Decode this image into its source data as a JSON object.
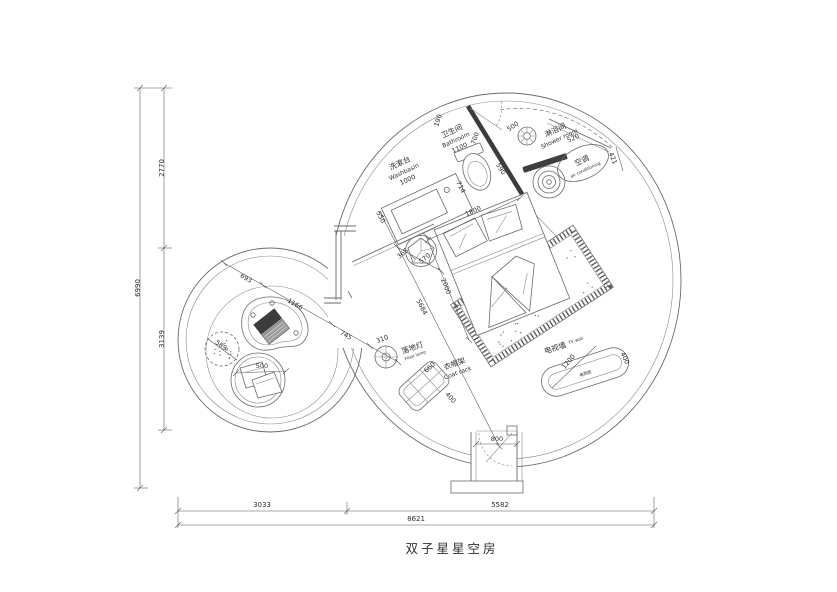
{
  "title": "双子星星空房",
  "labels": {
    "washbasin": {
      "cn": "洗漱台",
      "en": "Washbasin",
      "dim": "1000"
    },
    "bathroom": {
      "cn": "卫生间",
      "en": "Bathroom",
      "dim": "1100"
    },
    "shower": {
      "cn": "淋浴间",
      "en": "Shower room"
    },
    "ac": {
      "cn": "空调",
      "en": "air conditioning"
    },
    "floor_lamp": {
      "cn": "落地灯",
      "en": "Floor lamp"
    },
    "coat_rack": {
      "cn": "衣帽架",
      "en": "Coat rack"
    },
    "tv_wall": {
      "cn": "电视墙",
      "en": "TV wall"
    },
    "tv_cabinet": {
      "cn": "电视柜"
    }
  },
  "dims": {
    "wall_top": "190",
    "wall_side": "700",
    "shower_door": "500",
    "partition": "590",
    "ac_width": "520",
    "ac_depth": "421",
    "toilet": "714",
    "basin_offset": "550",
    "bed_width": "1800",
    "bed_length": "2000",
    "room_diag": "5684",
    "stool_a": "365",
    "stool_b": "570",
    "lc_a": "693",
    "lc_b": "1166",
    "lc_c": "745",
    "pouf": "589",
    "chair": "500",
    "lamp": "310",
    "coat_w": "660",
    "coat_d": "400",
    "door": "800",
    "tv_w": "1200",
    "tv_d": "400"
  },
  "overall": {
    "left_total": "6990",
    "left_upper": "2770",
    "left_lower": "3139",
    "bottom_left": "3033",
    "bottom_right": "5582",
    "bottom_total": "8621"
  }
}
